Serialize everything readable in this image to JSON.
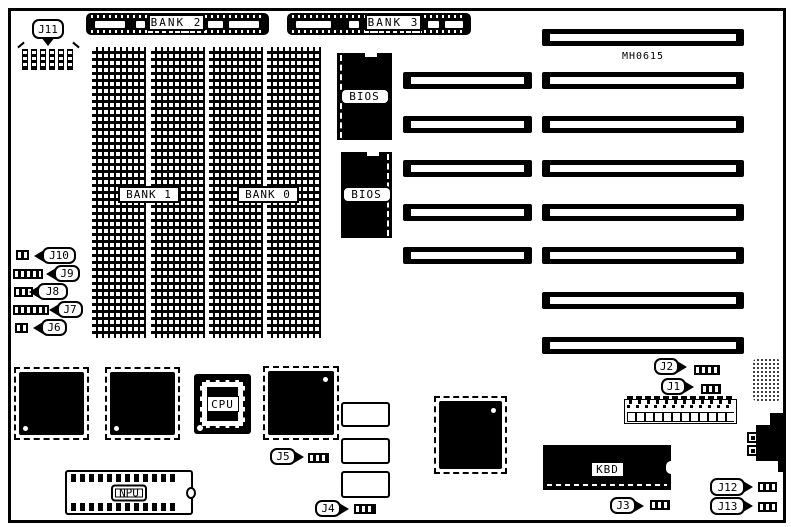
{
  "board": {
    "part_number": "MH0615"
  },
  "memory": {
    "bank0": "BANK 0",
    "bank1": "BANK 1",
    "bank2": "BANK 2",
    "bank3": "BANK 3"
  },
  "chips": {
    "bios_top": "BIOS",
    "bios_bottom": "BIOS",
    "cpu": "CPU",
    "npu": "NPU",
    "kbd": "KBD"
  },
  "jumpers": {
    "j1": "J1",
    "j2": "J2",
    "j3": "J3",
    "j4": "J4",
    "j5": "J5",
    "j6": "J6",
    "j7": "J7",
    "j8": "J8",
    "j9": "J9",
    "j10": "J10",
    "j11": "J11",
    "j12": "J12",
    "j13": "J13"
  },
  "colors": {
    "ink": "#000000",
    "background": "#ffffff"
  }
}
